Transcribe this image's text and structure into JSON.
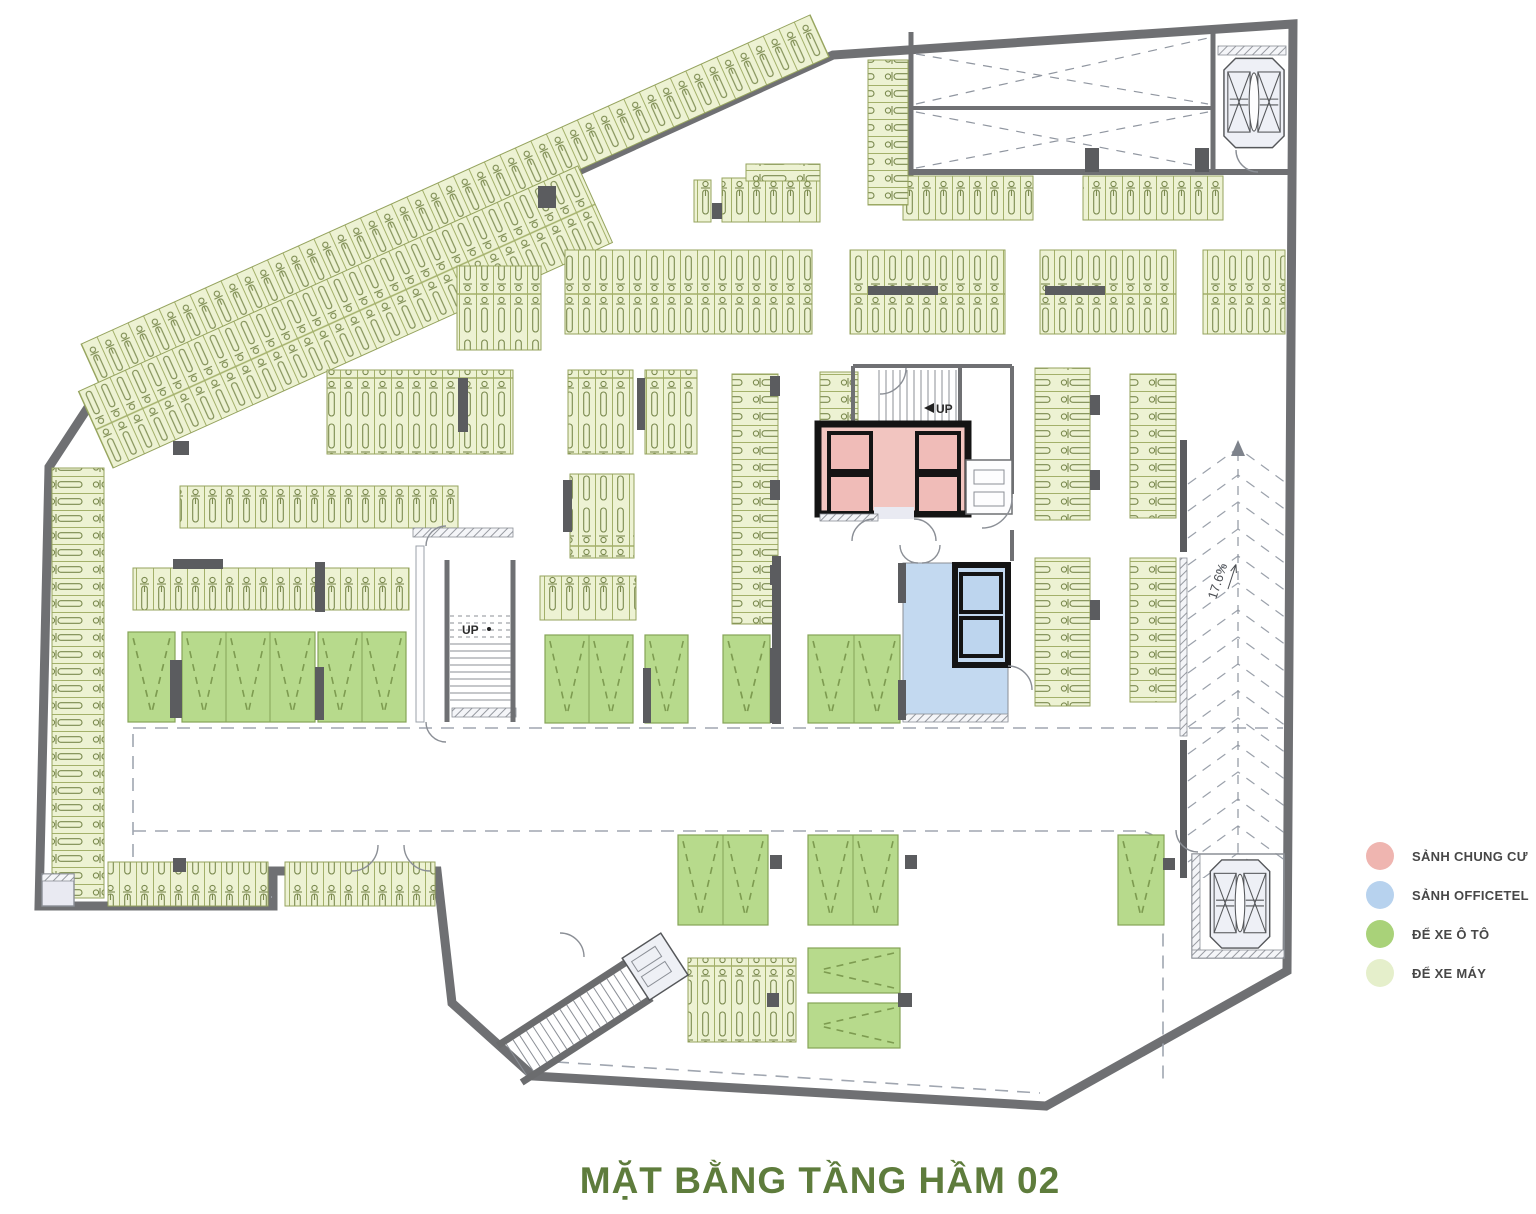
{
  "title": "MẶT BẰNG TẦNG HẦM 02",
  "legend": {
    "items": [
      {
        "id": "sanh-chung-cu",
        "label": "SẢNH CHUNG CƯ",
        "color": "#efb5b0"
      },
      {
        "id": "sanh-officetel",
        "label": "SẢNH OFFICETEL",
        "color": "#b7d2ee"
      },
      {
        "id": "de-xe-o-to",
        "label": "ĐỂ XE Ô TÔ",
        "color": "#a9d279"
      },
      {
        "id": "de-xe-may",
        "label": "ĐỂ XE MÁY",
        "color": "#e5efcb"
      }
    ]
  },
  "labels": {
    "stair_main_up": "UP",
    "stair_core_up": "UP",
    "ramp_slope": "17.6%"
  }
}
